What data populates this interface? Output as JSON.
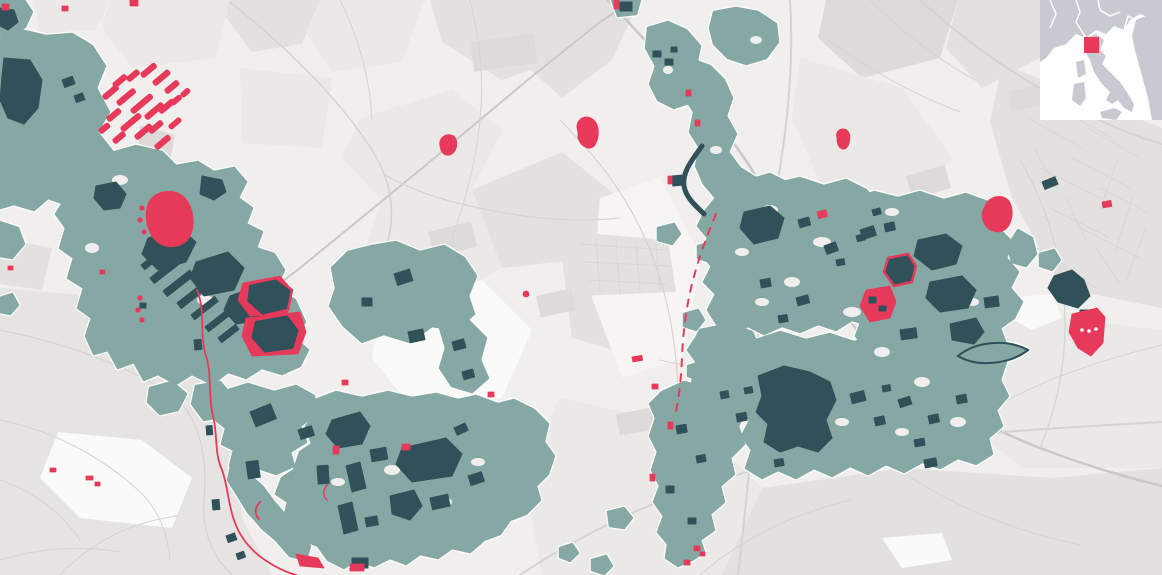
{
  "map": {
    "type": "land-cover-urbanization-map",
    "region_hint": "north-central Italy (locator inset)",
    "colors": {
      "background": "#f0efed",
      "parcel_light": "#eae9e7",
      "parcel_mid": "#e2e1df",
      "parcel_dark": "#dcdbd9",
      "patch_white": "#fafaf8",
      "patch_bright": "#f6f5f3",
      "hills": "#e5e4e2",
      "road": "#d4d3d1",
      "road_major": "#c9c8c6",
      "street": "#d8d7d5",
      "urban": "#86a8a5",
      "built": "#30505a",
      "highlight": "#e73a5b",
      "halo": "#fcfcfa"
    },
    "layers": [
      {
        "name": "base-parcels",
        "color_key": "parcel_mid"
      },
      {
        "name": "road-network",
        "color_key": "road"
      },
      {
        "name": "urbanized-areas",
        "color_key": "urban"
      },
      {
        "name": "dense-built-areas",
        "color_key": "built"
      },
      {
        "name": "highlighted-new-development",
        "color_key": "highlight"
      }
    ]
  },
  "inset": {
    "name": "italy-locator",
    "land_color": "#c7cbd1",
    "sea_color": "#ffffff",
    "border_color": "#ffffff",
    "marker_color": "#e73a5b",
    "marker": {
      "x": 44,
      "y": 37,
      "width": 15,
      "height": 16
    }
  }
}
